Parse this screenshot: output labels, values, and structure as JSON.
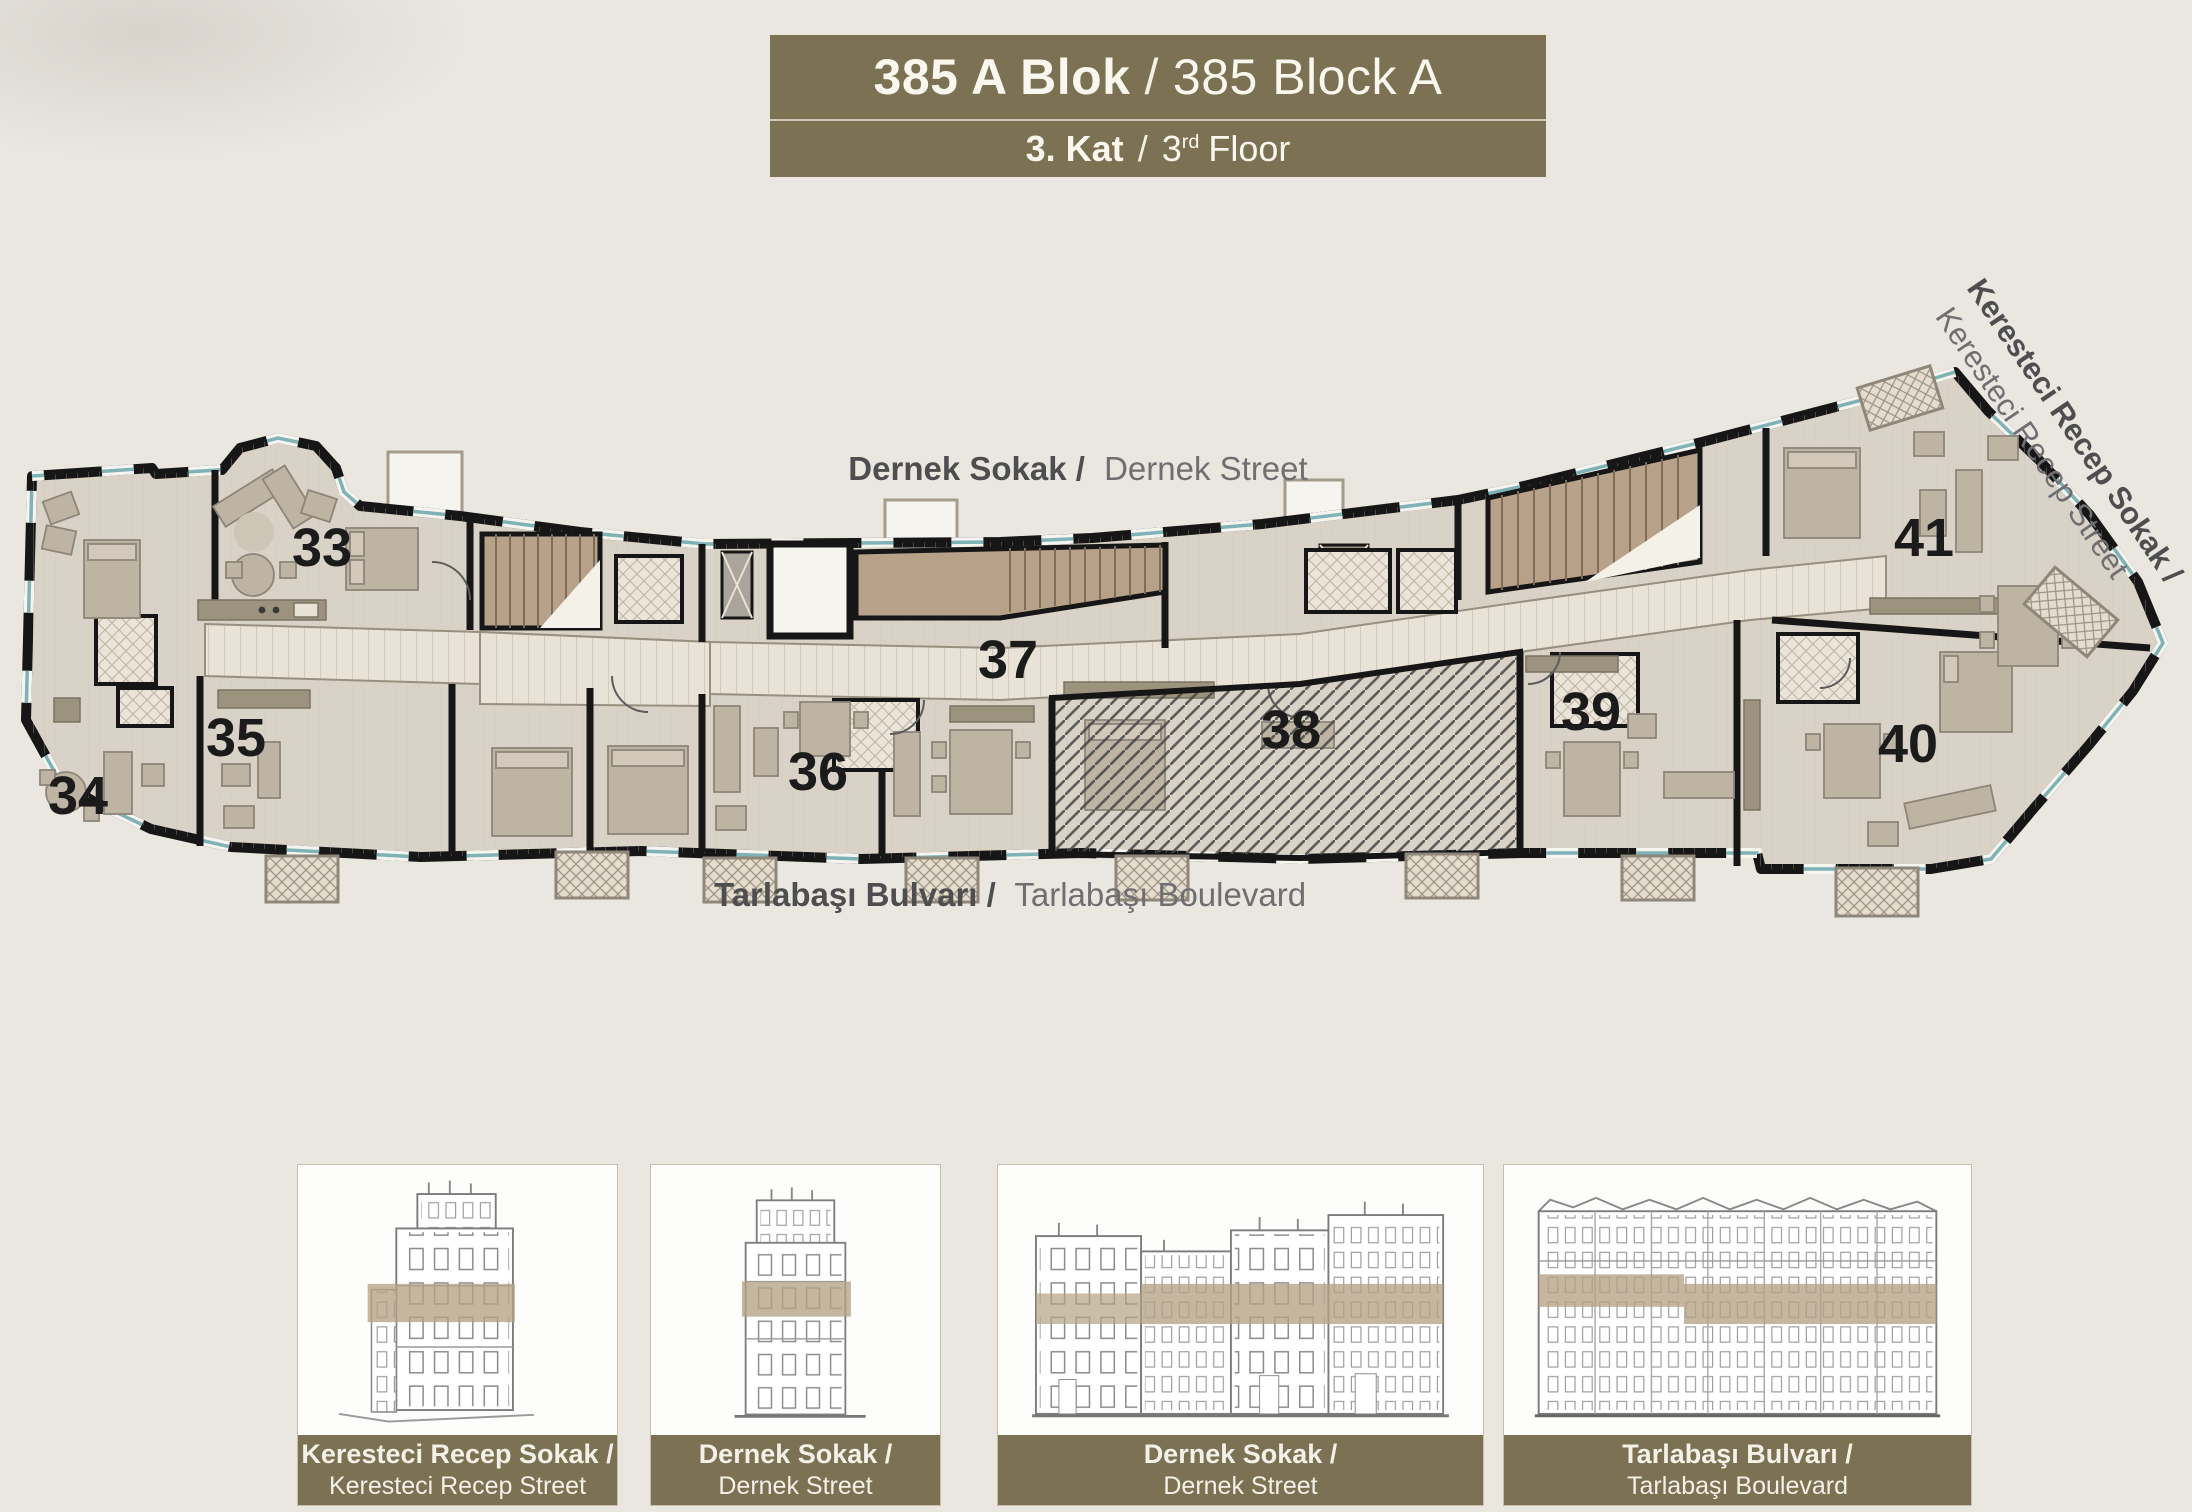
{
  "header": {
    "title_primary": "385 A Blok",
    "title_separator": "/",
    "title_secondary": "385 Block A",
    "subtitle_primary": "3. Kat",
    "subtitle_separator": "/",
    "subtitle_floor_number": "3",
    "subtitle_floor_suffix": "rd",
    "subtitle_floor_rest": "Floor"
  },
  "plan": {
    "streets": {
      "top_primary": "Dernek Sokak /",
      "top_secondary": "Dernek Street",
      "bottom_primary": "Tarlabaşı Bulvarı /",
      "bottom_secondary": "Tarlabaşı Boulevard",
      "right_primary": "Keresteci Recep Sokak /",
      "right_secondary": "Keresteci Recep Street"
    },
    "unit_numbers": [
      "33",
      "34",
      "35",
      "36",
      "37",
      "38",
      "39",
      "40",
      "41"
    ]
  },
  "elevations": [
    {
      "caption_primary": "Keresteci Recep Sokak /",
      "caption_secondary": "Keresteci Recep Street"
    },
    {
      "caption_primary": "Dernek Sokak /",
      "caption_secondary": "Dernek Street"
    },
    {
      "caption_primary": "Dernek Sokak /",
      "caption_secondary": "Dernek Street"
    },
    {
      "caption_primary": "Tarlabaşı Bulvarı /",
      "caption_secondary": "Tarlabaşı Boulevard"
    }
  ],
  "colors": {
    "accent_olive": "#7c7153",
    "floor_band_tan": "#b4a284",
    "window_teal": "#7fb2b5",
    "wall_black": "#161616"
  }
}
